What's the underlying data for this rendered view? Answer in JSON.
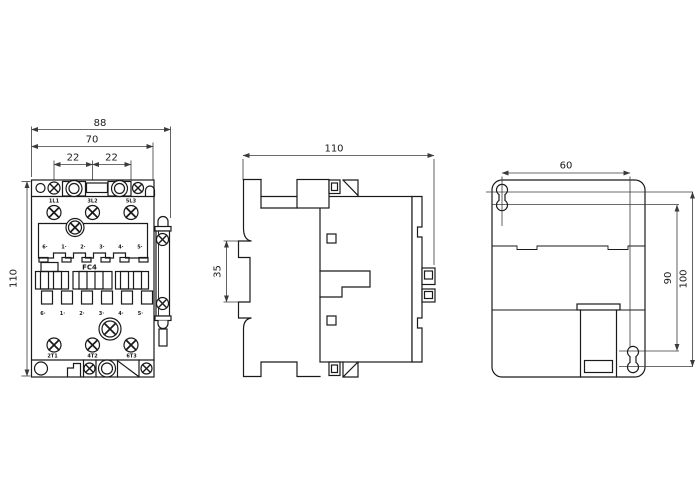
{
  "colors": {
    "background": "#ffffff",
    "outline": "#1a1a1a",
    "dimension_lines": "#3a3a3a"
  },
  "views": {
    "front": {
      "dimensions": {
        "overall_width": "88",
        "body_width": "70",
        "pole_pitch_left": "22",
        "pole_pitch_right": "22",
        "overall_height": "110"
      },
      "top_terminals": [
        "1L1",
        "3L2",
        "5L3"
      ],
      "bottom_terminals": [
        "2T1",
        "4T2",
        "6T3"
      ],
      "coil_terminal_numbers": [
        "6·",
        "1·",
        "2·",
        "3·",
        "4·",
        "5·"
      ],
      "device_label": "FC4"
    },
    "side": {
      "dimensions": {
        "depth": "110",
        "din_rail_slot": "35"
      }
    },
    "rear": {
      "dimensions": {
        "mounting_hole_pitch_width": "60",
        "mounting_hole_pitch_height": "90",
        "mounting_height": "100"
      }
    }
  }
}
